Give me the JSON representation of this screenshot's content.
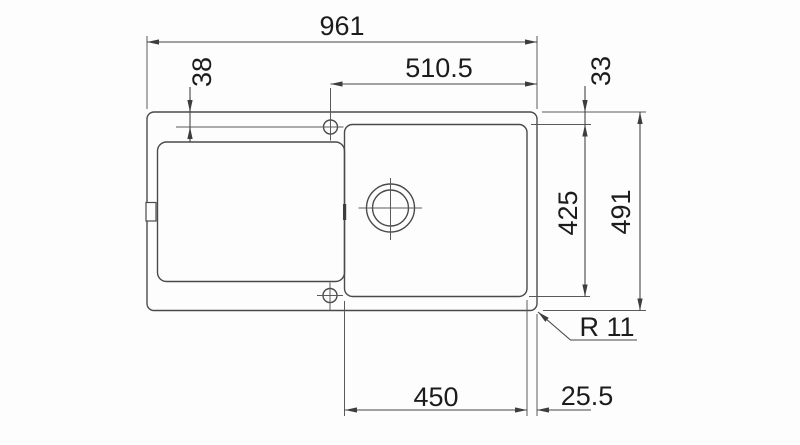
{
  "diagram": {
    "kind": "technical-drawing-top-view",
    "colors": {
      "line": "#4a4a4a",
      "dimension_text": "#1c1c1c",
      "background": "#fdfdfd"
    },
    "labels": {
      "overall_width": "961",
      "faucet_center_to_right_edge": "510.5",
      "top_edge_to_faucet_center": "38",
      "top_edge_to_bowl": "33",
      "bowl_front_to_back": "425",
      "overall_depth": "491",
      "corner_radius": "R 11",
      "bowl_width": "450",
      "bowl_to_right_edge": "25.5"
    }
  }
}
